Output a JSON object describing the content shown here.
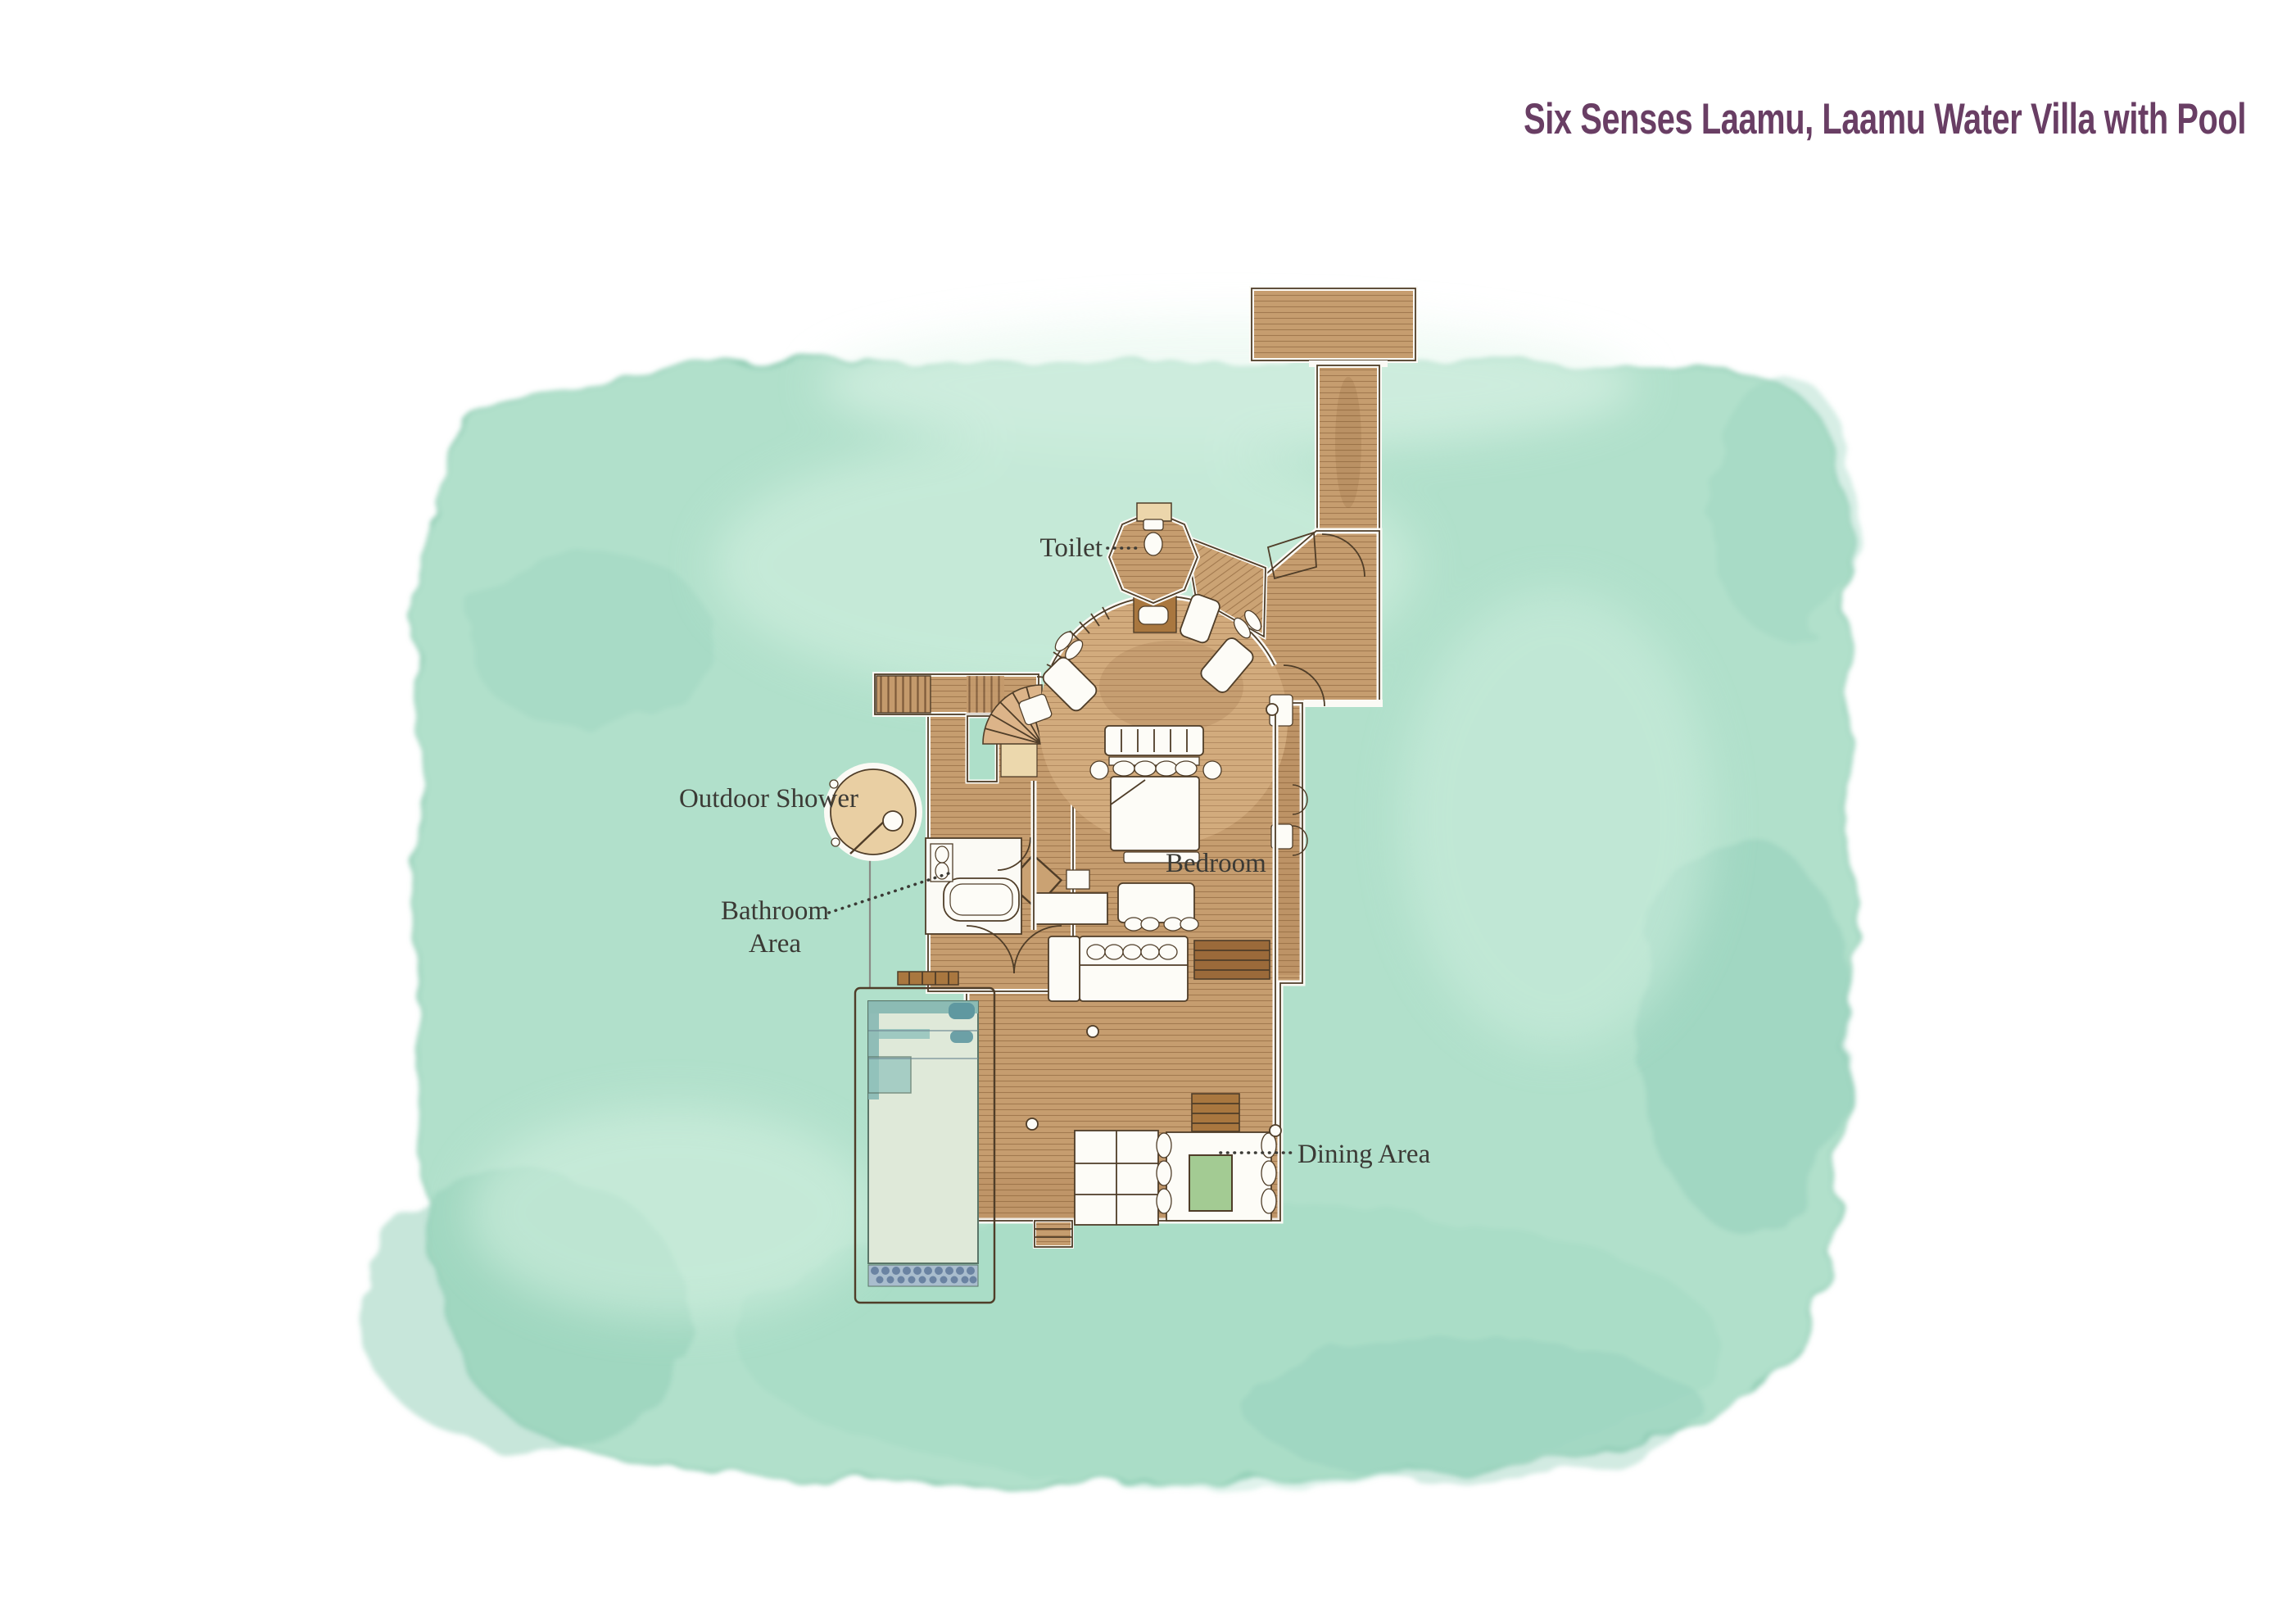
{
  "title": "Six Senses Laamu, Laamu Water Villa with Pool",
  "labels": {
    "toilet": "Toilet",
    "outdoor_shower": "Outdoor Shower",
    "bathroom_line1": "Bathroom",
    "bathroom_line2": "Area",
    "bedroom": "Bedroom",
    "dining_area": "Dining Area"
  },
  "colors": {
    "title_text": "#693e64",
    "label_text": "#3b3a35",
    "water_wash": "#aedfc9",
    "wood_deck": "#c69d6f",
    "wood_dark": "#a9773f",
    "pool_water": "#dfe9d9",
    "pool_tile": "#5f98a0",
    "dining_table_green": "#a3cb93",
    "page_background": "#ffffff"
  }
}
